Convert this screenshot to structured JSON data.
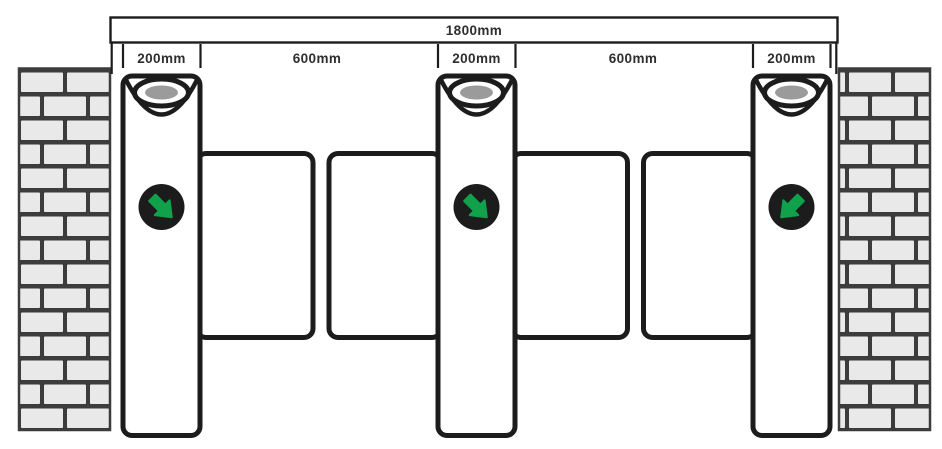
{
  "diagram": {
    "overall_width_label": "1800mm",
    "segment_labels": [
      "200mm",
      "600mm",
      "200mm",
      "600mm",
      "200mm"
    ],
    "pillars": [
      {
        "name": "pillar-1",
        "arrow_direction": "down-right"
      },
      {
        "name": "pillar-2",
        "arrow_direction": "down-right"
      },
      {
        "name": "pillar-3",
        "arrow_direction": "down-left"
      }
    ],
    "colors": {
      "line": "#1c1c1c",
      "text": "#2e2e2e",
      "brick": "#e9e9e9",
      "mortar": "#3c3c3c",
      "indicator_green": "#12a14b",
      "reader_gray": "#9b9b9b",
      "background": "#ffffff"
    }
  }
}
